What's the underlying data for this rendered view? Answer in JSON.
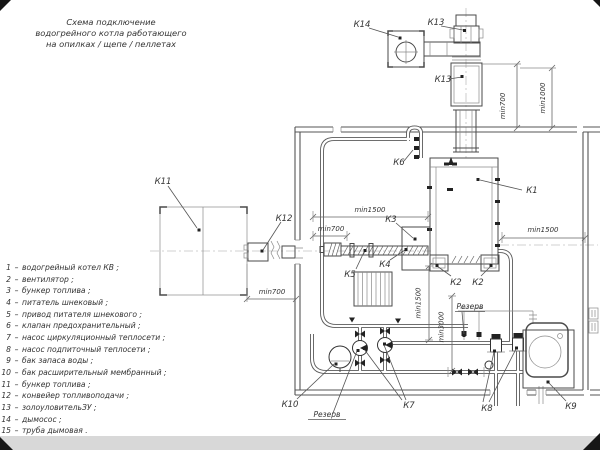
{
  "title": {
    "lines": [
      "Схема подключение",
      "водогрейного котла работающего",
      "на опилках / щепе / пеллетах"
    ]
  },
  "legend": {
    "dash": "–",
    "items": [
      {
        "n": "1",
        "t": "водогрейный котел КВ ;"
      },
      {
        "n": "2",
        "t": "вентилятор ;"
      },
      {
        "n": "3",
        "t": "бункер топлива ;"
      },
      {
        "n": "4",
        "t": "питатель шнековый ;"
      },
      {
        "n": "5",
        "t": "привод питателя шнекового ;"
      },
      {
        "n": "6",
        "t": "клапан предохранительный ;"
      },
      {
        "n": "7",
        "t": "насос циркуляционный теплосети ;"
      },
      {
        "n": "8",
        "t": "насос подпиточный теплосети ;"
      },
      {
        "n": "9",
        "t": "бак запаса воды ;"
      },
      {
        "n": "10",
        "t": "бак расширительный мембранный ;"
      },
      {
        "n": "11",
        "t": "бункер топлива ;"
      },
      {
        "n": "12",
        "t": "конвейер топливоподачи ;"
      },
      {
        "n": "13",
        "t": "золоуловительЗУ ;"
      },
      {
        "n": "14",
        "t": "дымосос ;"
      },
      {
        "n": "15",
        "t": "труба дымовая ."
      }
    ]
  },
  "labels": {
    "k1": "К1",
    "k2": "К2",
    "k3": "К3",
    "k4": "К4",
    "k5": "К5",
    "k6": "К6",
    "k7": "К7",
    "k8": "К8",
    "k9": "К9",
    "k10": "К10",
    "k11": "К11",
    "k12": "К12",
    "k13": "К13",
    "k14": "К14",
    "reserve": "Резерв"
  },
  "dims": {
    "min700": "min700",
    "min1000": "min1000",
    "min1500": "min1500",
    "min3000": "min3000"
  },
  "colors": {
    "background": "#ffffff",
    "line": "#4a4a4a",
    "wall": "#555555",
    "centerline": "#c2c2c2",
    "text": "#333333",
    "bottom_band": "#d8d8d8",
    "corner_mark": "#161616"
  }
}
